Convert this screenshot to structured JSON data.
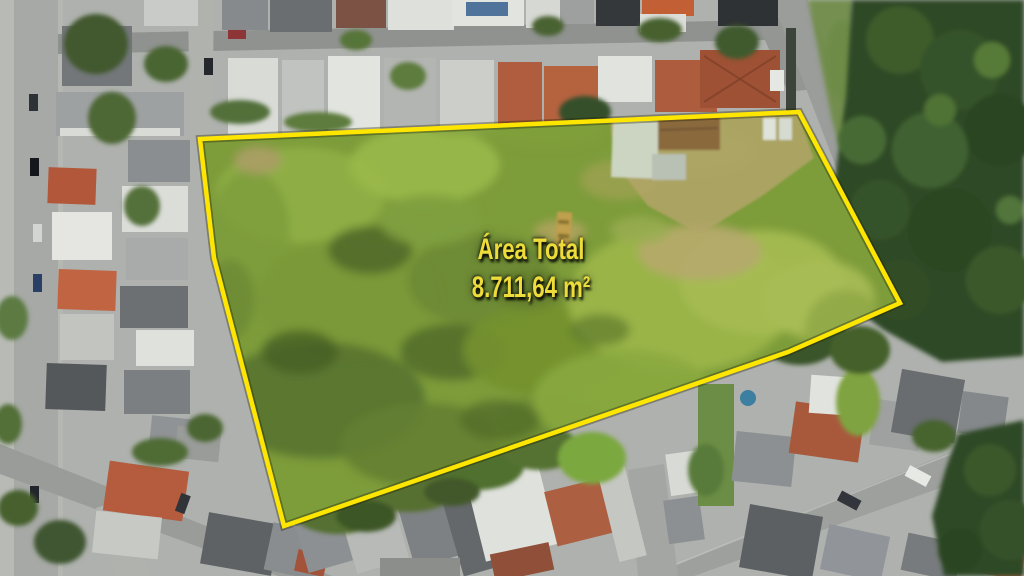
{
  "annotation": {
    "line1": "Área Total",
    "line2": "8.711,64 m²"
  },
  "colors": {
    "boundary_yellow": "#ffe600",
    "annotation_text_yellow": "#eedc3a"
  }
}
